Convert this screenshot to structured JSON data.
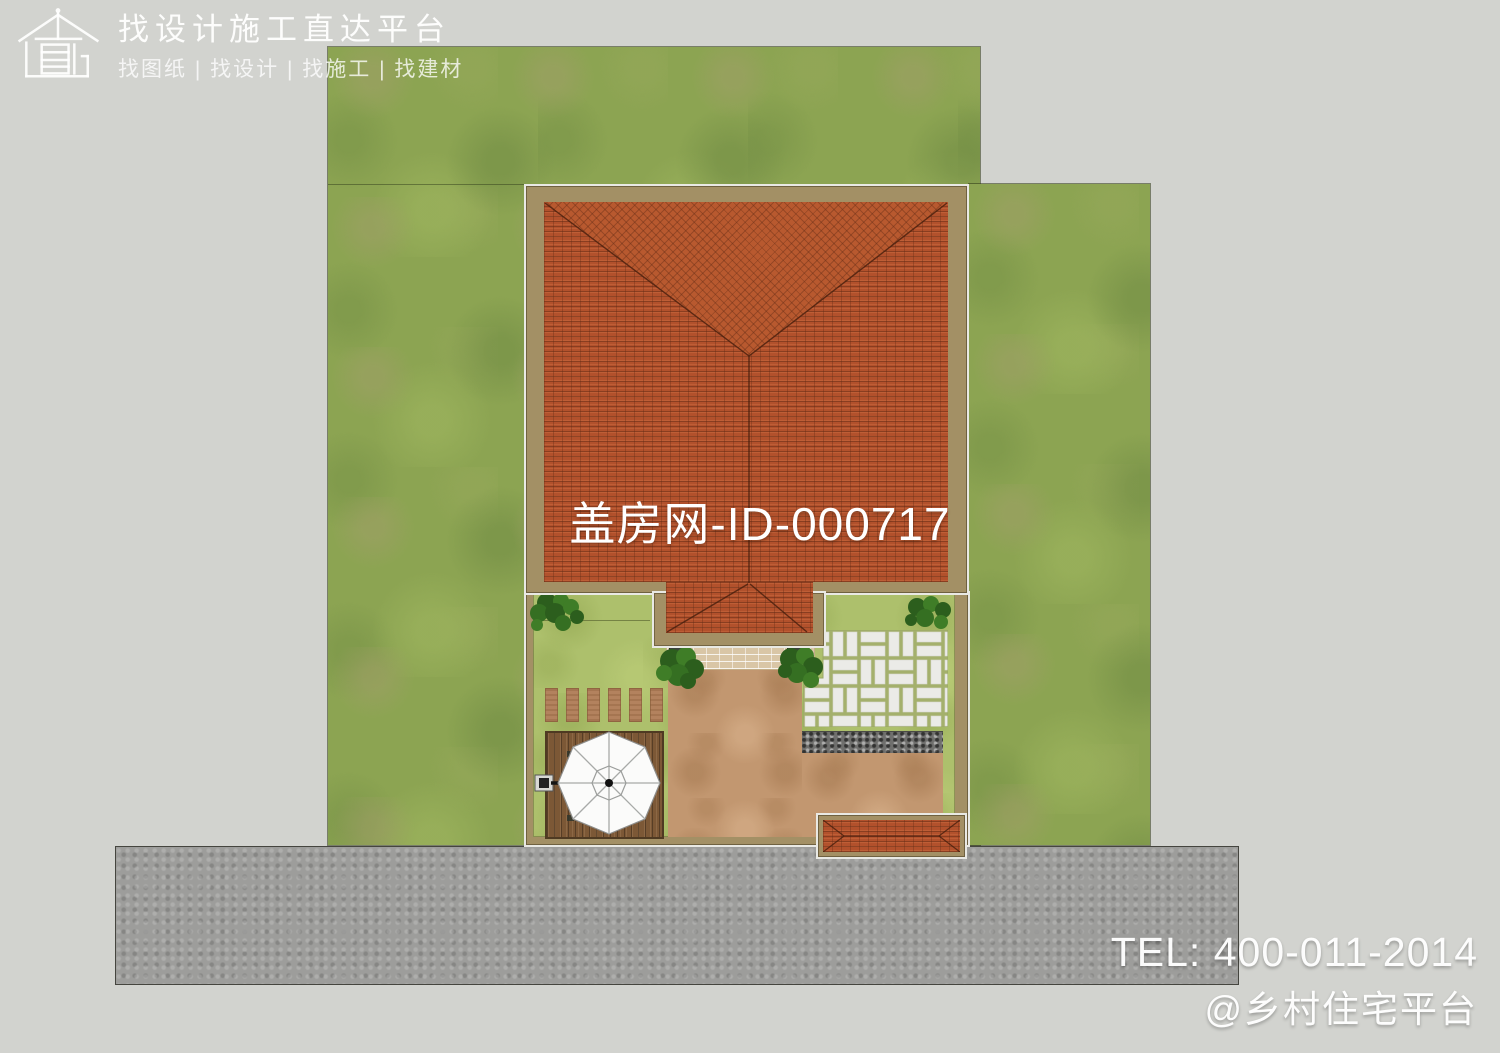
{
  "brand": {
    "icon": "house-direct-logo",
    "title": "找设计施工直达平台",
    "subtitle": "找图纸 | 找设计 | 找施工 | 找建材"
  },
  "watermark": {
    "text": "盖房网-ID-000717"
  },
  "contact": {
    "tel": "TEL: 400-011-2014",
    "handle": "@乡村住宅平台"
  },
  "scene": {
    "type": "aerial-site-plan-render",
    "elements": [
      "lawn-left",
      "lawn-right",
      "asphalt-road",
      "hip-roof-house",
      "entry-porch-roof",
      "walled-courtyard",
      "white-paver-patio",
      "gravel-strip",
      "clay-paved-path",
      "entry-steps",
      "entry-planters",
      "stepping-planks",
      "wood-deck",
      "cantilever-umbrella",
      "garden-tree-northwest",
      "garden-tree-northeast",
      "entry-shrub-left",
      "entry-shrub-right",
      "gate-canopy"
    ],
    "colors": {
      "background": "#d2d3cf",
      "lawn": "#8ca452",
      "courtyard_grass": "#adc06c",
      "roof_tile": "#b2512c",
      "wall_tan": "#a39065",
      "clay_path": "#c29770",
      "paver_white": "#ebebe7",
      "paver_joint": "#a4b06c",
      "gravel": "#6f6f6d",
      "deck_wood": "#7c5836",
      "road": "#9d9d9b",
      "umbrella": "#fbfbfa",
      "overlay_text": "#ffffff"
    }
  }
}
